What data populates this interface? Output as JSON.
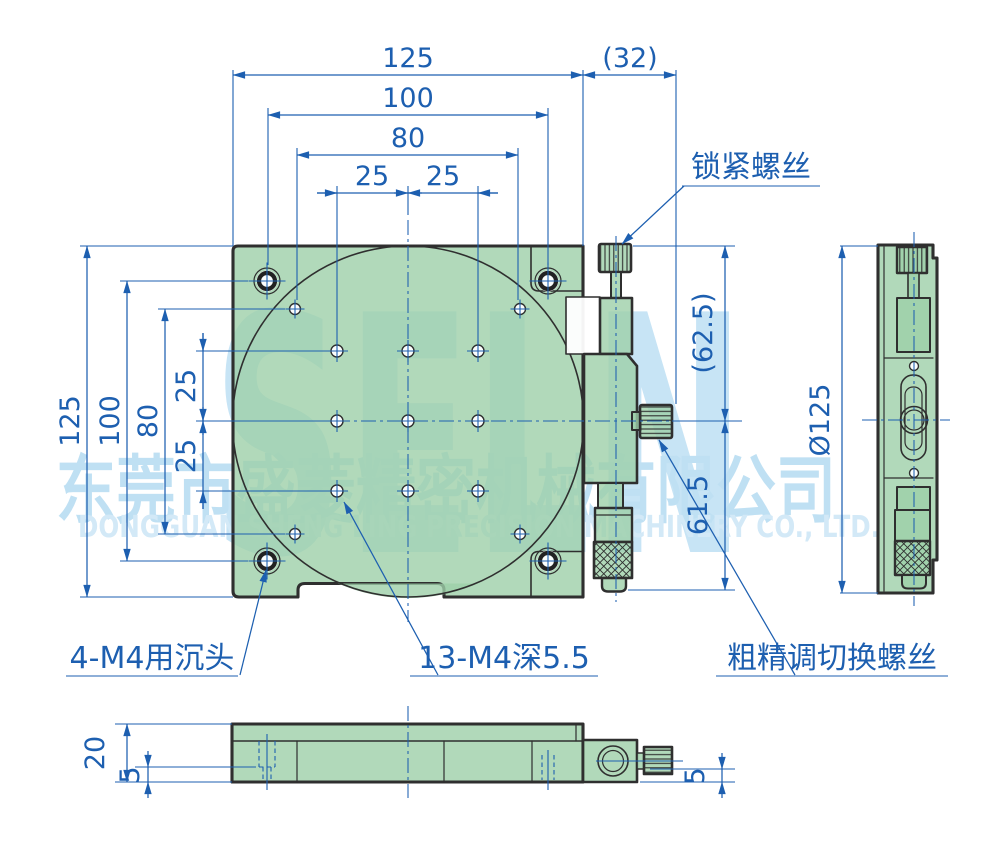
{
  "title": "精密旋转台工程图",
  "colors": {
    "annotation_blue": "#1d5fb0",
    "plate_green": "#9dcfa9",
    "outline_dark": "#2f2f2f",
    "watermark_blue": "#c7e4f5"
  },
  "dimensions": {
    "top": [
      "125",
      "100",
      "80",
      "25",
      "25",
      "(32)"
    ],
    "left": [
      "125",
      "100",
      "80",
      "25",
      "25"
    ],
    "right": [
      "(62.5)",
      "61.5"
    ],
    "side": [
      "Ø125"
    ],
    "bottom": [
      "20",
      "5",
      "5"
    ]
  },
  "callouts": {
    "locking_screw": "锁紧螺丝",
    "countersunk_holes": "4-M4用沉头",
    "tapped_holes": "13-M4深5.5",
    "coarse_fine_switch": "粗精调切换螺丝"
  },
  "watermark": {
    "logo": "SELN",
    "company_cn": "东莞市盛菱精密机械有限公司",
    "company_en": "DONGGUAN SHENG LING PRECISION MACHINERY CO., LTD."
  }
}
